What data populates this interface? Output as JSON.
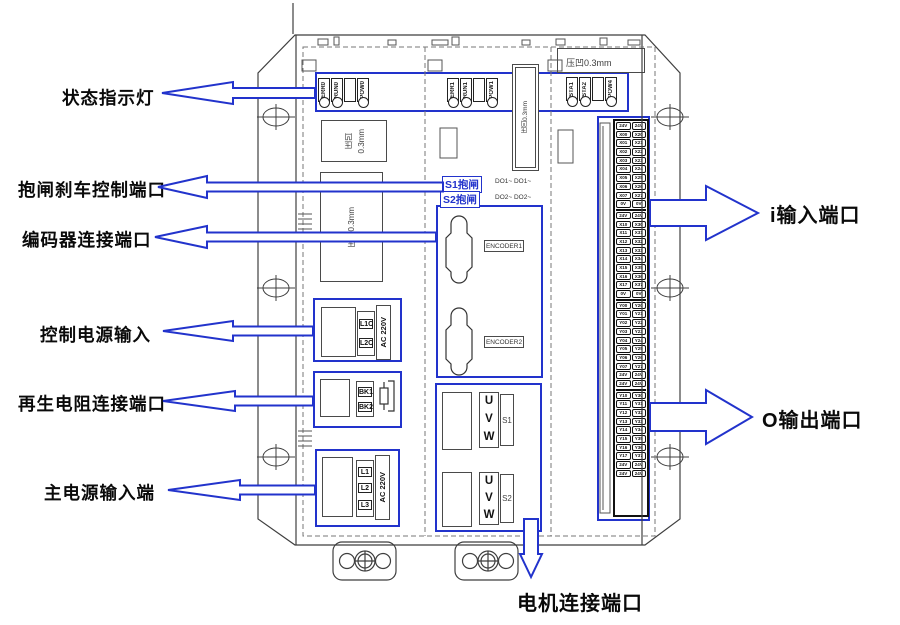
{
  "colors": {
    "accent": "#2233cc",
    "line": "#3f3f3f"
  },
  "callouts": {
    "status": "状态指示灯",
    "brake": "抱闸刹车控制端口",
    "encoder": "编码器连接端口",
    "control_power": "控制电源输入",
    "regen_resistor": "再生电阻连接端口",
    "main_power": "主电源输入端",
    "input_port": "i输入端口",
    "output_port": "O输出端口",
    "motor_port": "电机连接端口"
  },
  "led_groups": [
    {
      "labels": [
        "ERR0",
        "RUN0",
        "",
        "POW0"
      ]
    },
    {
      "labels": [
        "ERR1",
        "RUN1",
        "",
        "POW1"
      ]
    },
    {
      "labels": [
        "STA1",
        "STA2",
        "",
        "POW4"
      ]
    }
  ],
  "emboss": {
    "left_small_line1": "压凹",
    "left_small_line2": "0.3mm",
    "left_large": "压凹0.3mm",
    "mid_vertical": "压凹0.3mm",
    "right_top": "压凹0.3mm"
  },
  "brake_port": {
    "s1": "S1抱闸",
    "s2": "S2抱闸",
    "do1": "DO1~ DO1~",
    "do2": "DO2~ DO2~"
  },
  "encoder_port": {
    "enc1": "ENCODER1",
    "enc2": "ENCODER2"
  },
  "motor_port": {
    "phases": [
      "U",
      "V",
      "W"
    ],
    "group1_label": "S1",
    "group2_label": "S2"
  },
  "control_power": {
    "terminals": [
      "L1C",
      "L2C"
    ],
    "voltage": "AC 220V"
  },
  "regen_port": {
    "terminals": [
      "BK1",
      "BK2"
    ]
  },
  "main_power": {
    "terminals": [
      "L1",
      "L2",
      "L3"
    ],
    "voltage": "AC 220V"
  },
  "io_block": {
    "groups": [
      {
        "rows": [
          [
            "24V",
            "24V"
          ],
          [
            "X00",
            "X20"
          ],
          [
            "X01",
            "X21"
          ],
          [
            "X02",
            "X22"
          ],
          [
            "X03",
            "X23"
          ],
          [
            "X04",
            "X24"
          ],
          [
            "X05",
            "X25"
          ],
          [
            "X06",
            "X26"
          ],
          [
            "X07",
            "X27"
          ],
          [
            "0V",
            "0V"
          ]
        ]
      },
      {
        "rows": [
          [
            "24V",
            "24V"
          ],
          [
            "X10",
            "X30"
          ],
          [
            "X11",
            "X31"
          ],
          [
            "X12",
            "X32"
          ],
          [
            "X13",
            "X33"
          ],
          [
            "X14",
            "X34"
          ],
          [
            "X15",
            "X35"
          ],
          [
            "X16",
            "X36"
          ],
          [
            "X17",
            "X37"
          ],
          [
            "0V",
            "0V"
          ]
        ]
      },
      {
        "rows": [
          [
            "Y00",
            "Y20"
          ],
          [
            "Y01",
            "Y21"
          ],
          [
            "Y02",
            "Y22"
          ],
          [
            "Y03",
            "Y23"
          ],
          [
            "Y04",
            "Y24"
          ],
          [
            "Y05",
            "Y25"
          ],
          [
            "Y06",
            "Y26"
          ],
          [
            "Y07",
            "Y27"
          ],
          [
            "24V",
            "24V"
          ],
          [
            "24V",
            "24V"
          ]
        ]
      },
      {
        "rows": [
          [
            "Y10",
            "Y30"
          ],
          [
            "Y11",
            "Y31"
          ],
          [
            "Y12",
            "Y32"
          ],
          [
            "Y13",
            "Y33"
          ],
          [
            "Y14",
            "Y34"
          ],
          [
            "Y15",
            "Y35"
          ],
          [
            "Y16",
            "Y36"
          ],
          [
            "Y17",
            "Y37"
          ],
          [
            "24V",
            "24V"
          ],
          [
            "24V",
            "24V"
          ]
        ]
      }
    ]
  }
}
